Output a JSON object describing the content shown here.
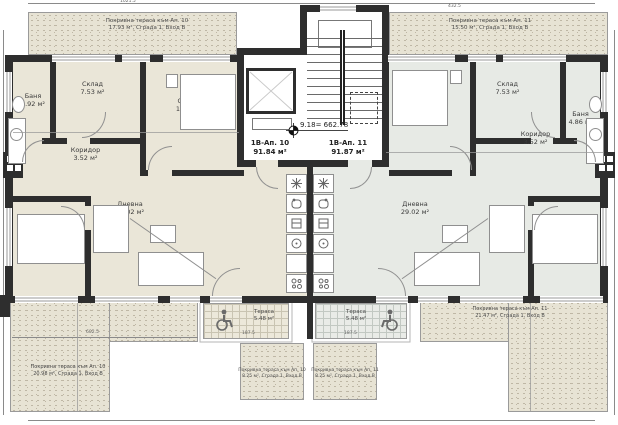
{
  "colors": {
    "wall": "#2e2e2e",
    "ap10_fill": "#eae6d8",
    "ap11_fill": "#e7eae5",
    "stipple": "#e7e3d4",
    "accent_gray": "#9a9a9a"
  },
  "level_mark": "9.18= 662.78",
  "apartments": {
    "ap10": {
      "label": "1В-Ап. 10",
      "area": "91.84 м²"
    },
    "ap11": {
      "label": "1В-Ап. 11",
      "area": "91.87 м²"
    }
  },
  "rooms": {
    "ap10_bath": {
      "name": "Баня",
      "area": "4.92 м²"
    },
    "ap10_storage": {
      "name": "Склад",
      "area": "7.53 м²"
    },
    "ap10_bedroom1": {
      "name": "Спалня",
      "area": "12.05 м²"
    },
    "ap10_corridor": {
      "name": "Коридор",
      "area": "3.52 м²"
    },
    "ap10_bedroom2": {
      "name": "Спалня",
      "area": "13.66 м²"
    },
    "ap10_living": {
      "name": "Дневна",
      "area": "29.02 м²"
    },
    "ap11_bedroom1": {
      "name": "Спалня",
      "area": "11.96 м²"
    },
    "ap11_storage": {
      "name": "Склад",
      "area": "7.53 м²"
    },
    "ap11_bath": {
      "name": "Баня",
      "area": "4.86 м²"
    },
    "ap11_corridor": {
      "name": "Коридор",
      "area": "3.52 м²"
    },
    "ap11_living": {
      "name": "Дневна",
      "area": "29.02 м²"
    },
    "ap11_bedroom2": {
      "name": "Спалня",
      "area": "13.71 м²"
    }
  },
  "terraces": {
    "top_left": {
      "line1": "Покривна тераса към Ап. 10",
      "line2": "17.93 м², Сграда 1, Вход В"
    },
    "top_right": {
      "line1": "Покривна тераса към Ап. 11",
      "line2": "15.50 м², Сграда 1, Вход В"
    },
    "bottom_left": {
      "line1": "Покривна тераса към Ап. 10",
      "line2": "20.98 м², Сграда 1, Вход В"
    },
    "bottom_right": {
      "line1": "Покривна тераса към Ап. 11",
      "line2": "21.47 м², Сграда 1, Вход В"
    },
    "balcony_left": {
      "name": "Тераса",
      "area": "5.48 м²"
    },
    "balcony_right": {
      "name": "Тераса",
      "area": "5.48 м²"
    },
    "roof_small_left": {
      "line1": "Покривна тераса към Ап. 10",
      "line2": "8.25 м², Сграда 1, Вход В"
    },
    "roof_small_right": {
      "line1": "Покривна тераса към Ап. 11",
      "line2": "8.25 м², Сграда 1, Вход В"
    }
  },
  "dimensions": {
    "top_left": "1021.5",
    "top_right": "432.5",
    "bottom_left": "602.5",
    "balcony_left": "187.5",
    "balcony_right": "187.5"
  }
}
